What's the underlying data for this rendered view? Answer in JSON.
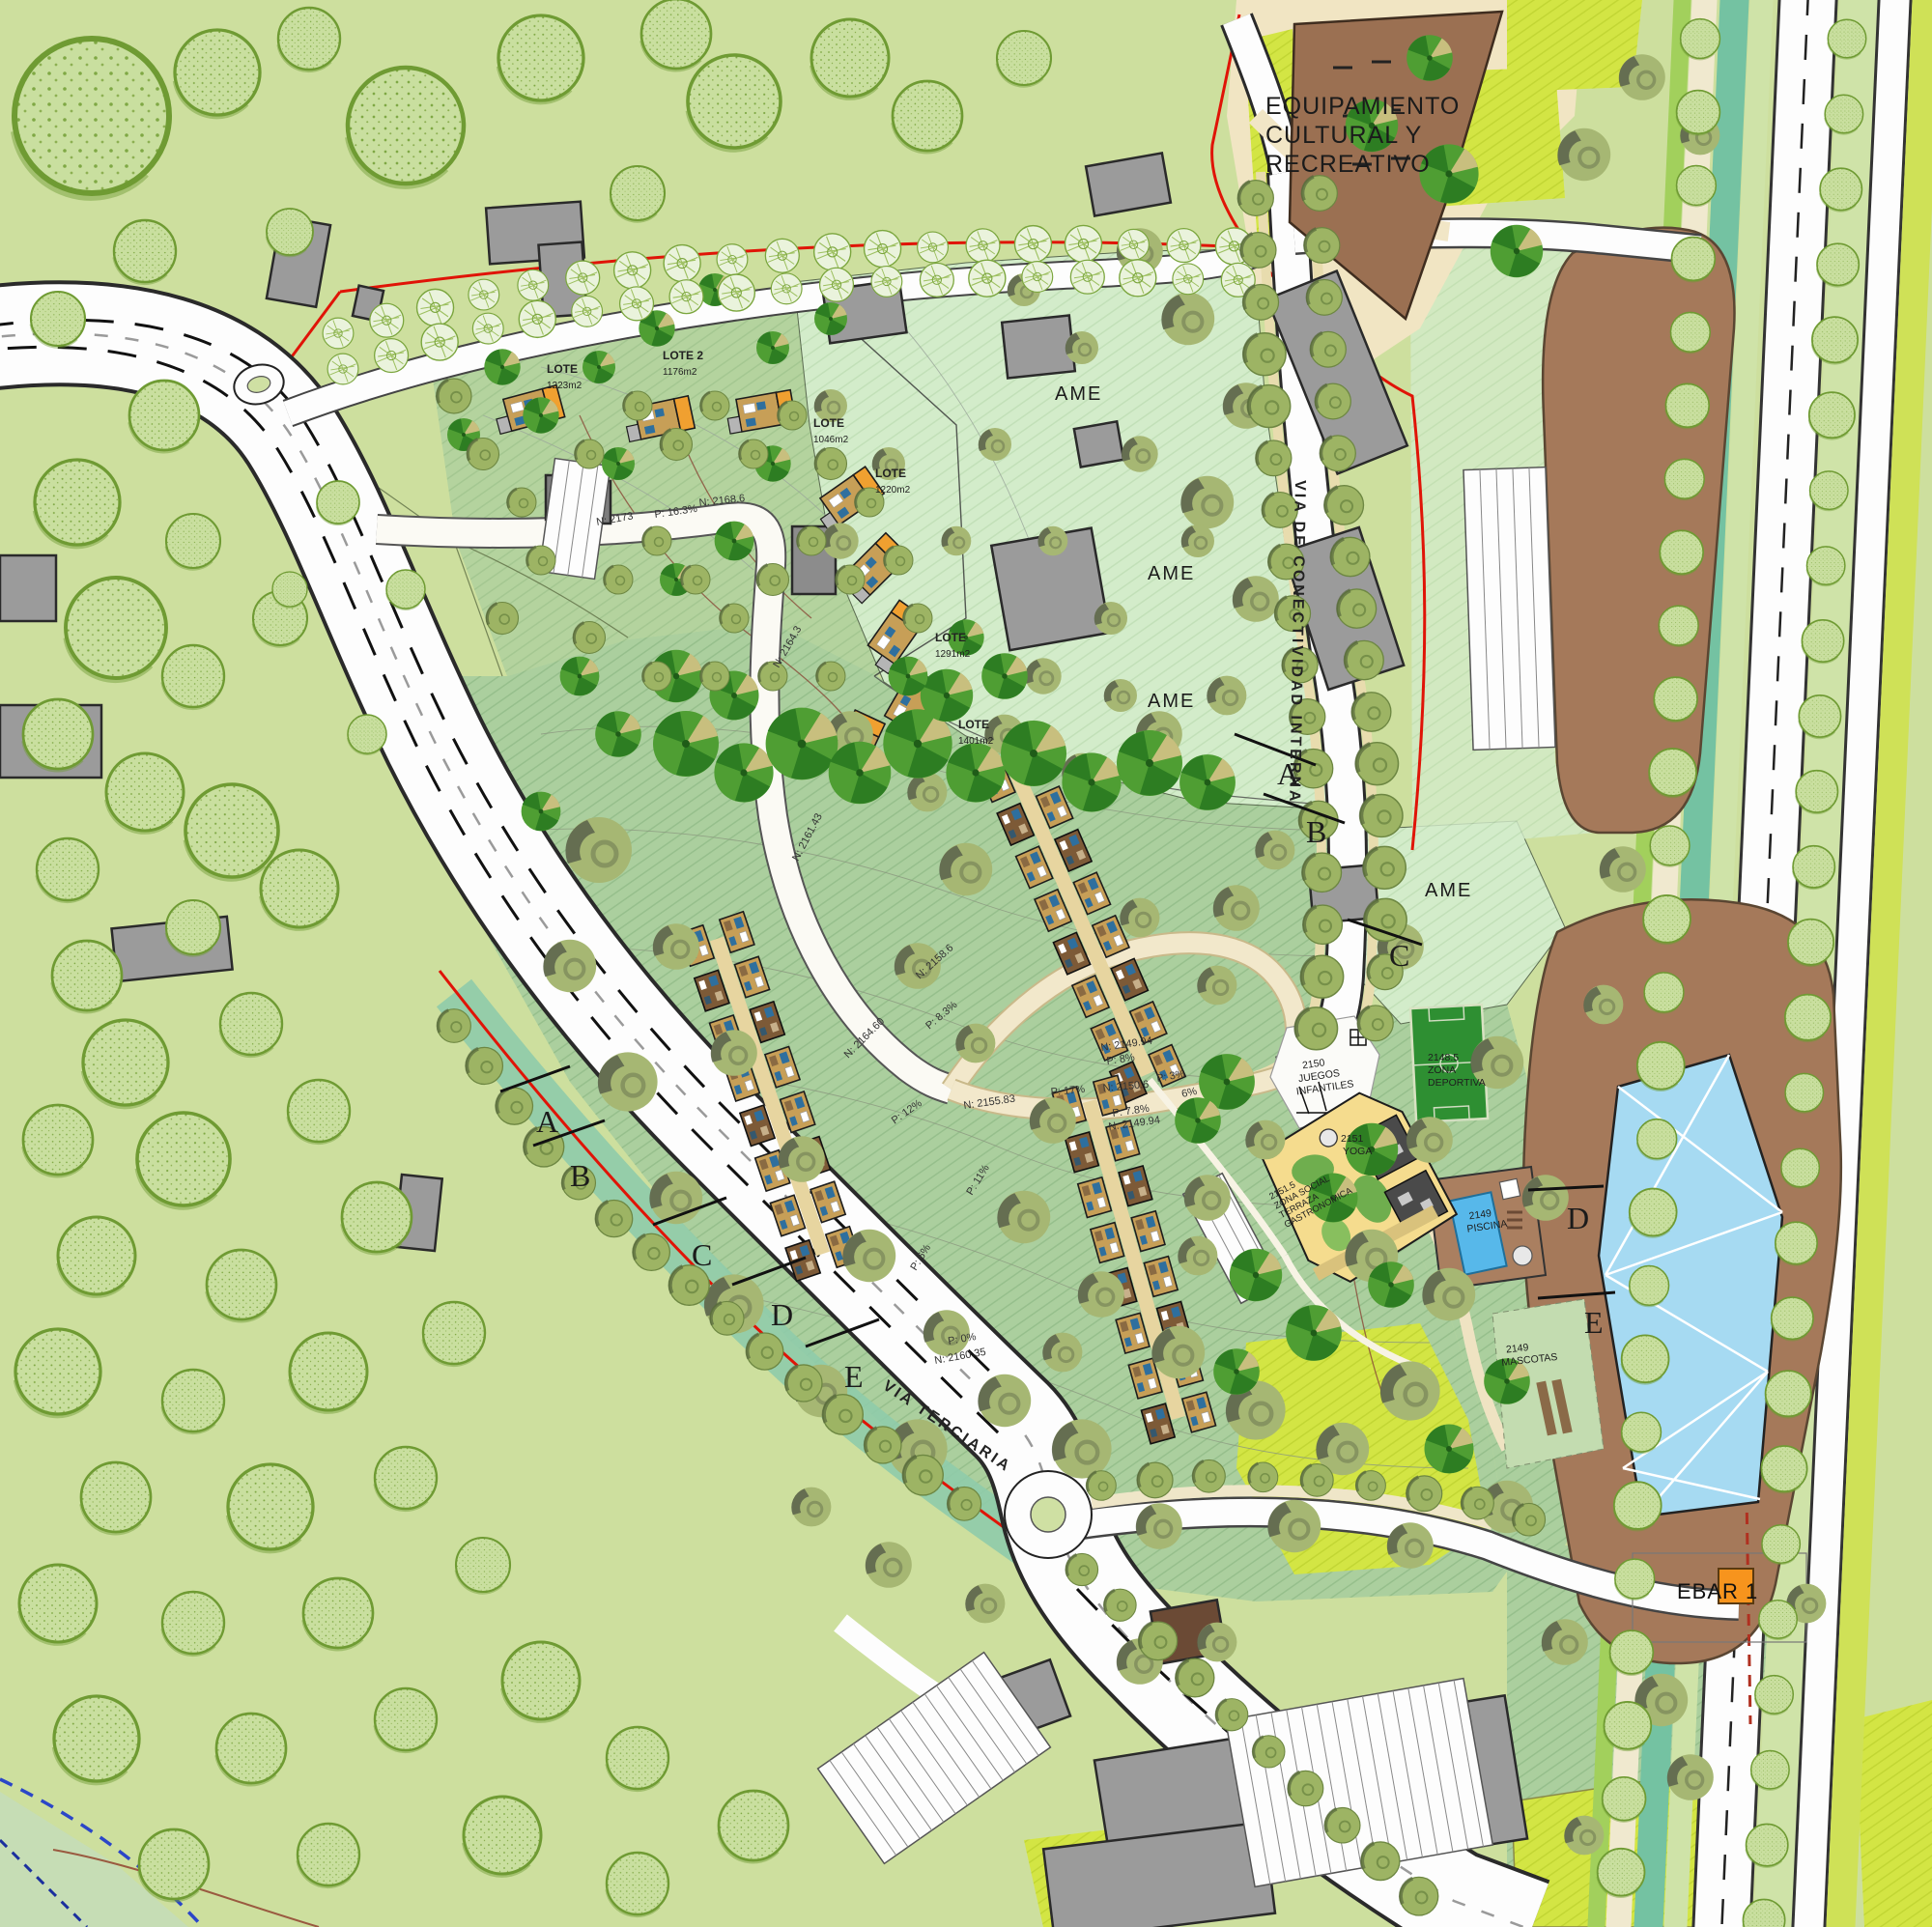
{
  "map": {
    "equipamiento": {
      "line1": "EQUIPAMIENTO",
      "line2": "CULTURAL Y",
      "line3": "RECREATIVO"
    },
    "ame": [
      "AME",
      "AME",
      "AME",
      "AME"
    ],
    "ebar_label": "EBAR 1",
    "roads": {
      "terciaria": "VIA TERCIARIA",
      "interna": "VIA DE CONECTIVIDAD INTERNA"
    },
    "sections_right": [
      "A",
      "B",
      "C",
      "D",
      "E"
    ],
    "sections_left": [
      "A",
      "B",
      "C",
      "D",
      "E"
    ],
    "lotes": [
      {
        "name": "LOTE",
        "area": "1223m2"
      },
      {
        "name": "LOTE 2",
        "area": "1176m2"
      },
      {
        "name": "LOTE",
        "area": "1046m2"
      },
      {
        "name": "LOTE",
        "area": "1220m2"
      },
      {
        "name": "LOTE",
        "area": "1291m2"
      },
      {
        "name": "LOTE",
        "area": "1401m2"
      }
    ],
    "amenities": {
      "deportiva": {
        "elev": "2148.5",
        "line1": "ZONA",
        "line2": "DEPORTIVA"
      },
      "juegos": {
        "elev": "2150",
        "line1": "JUEGOS",
        "line2": "INFANTILES"
      },
      "yoga": {
        "elev": "2151",
        "line1": "YOGA"
      },
      "piscina": {
        "elev": "2149",
        "line1": "PISCINA"
      },
      "mascotas": {
        "elev": "2149",
        "line1": "MASCOTAS"
      },
      "social": {
        "elev": "2151.5",
        "line1": "ZONA SOCIAL",
        "line2": "TERRAZA",
        "line3": "GASTRONOMICA"
      }
    },
    "marks": [
      {
        "t": "N: 2173"
      },
      {
        "t": "P: 16.3%"
      },
      {
        "t": "N: 2168.6"
      },
      {
        "t": "N: 2164.3"
      },
      {
        "t": "N: 2161.43"
      },
      {
        "t": "P: 8.3%"
      },
      {
        "t": "N: 2164.60"
      },
      {
        "t": "N: 2158.6"
      },
      {
        "t": "P: 12%"
      },
      {
        "t": "N: 2155.83"
      },
      {
        "t": "P: 17%"
      },
      {
        "t": "N: 2150.6"
      },
      {
        "t": "P: 8%"
      },
      {
        "t": "N: 2149.94"
      },
      {
        "t": "P: 3%"
      },
      {
        "t": "6%"
      },
      {
        "t": "P: 7.8%"
      },
      {
        "t": "N: 2149.94"
      },
      {
        "t": "P: 11%"
      },
      {
        "t": "P: 6%"
      },
      {
        "t": "P: 0%"
      },
      {
        "t": "N: 2160.35"
      }
    ],
    "colors": {
      "background": "#cddf9e",
      "dev_green": "#abcf9e",
      "mint": "#d3ecca",
      "chartreuse": "#d3e544",
      "brown": "#a5795a",
      "road_white": "#fdfdfd",
      "red_line": "#e01407",
      "pool_blue": "#57b8ea",
      "field_green": "#2e8f32",
      "ebar_orange": "#f7941d",
      "teal_hedge": "#74c2a2",
      "building_gray": "#9b9b9b",
      "house_tan": "#c79f57",
      "roof_orange": "#f0a030"
    }
  }
}
